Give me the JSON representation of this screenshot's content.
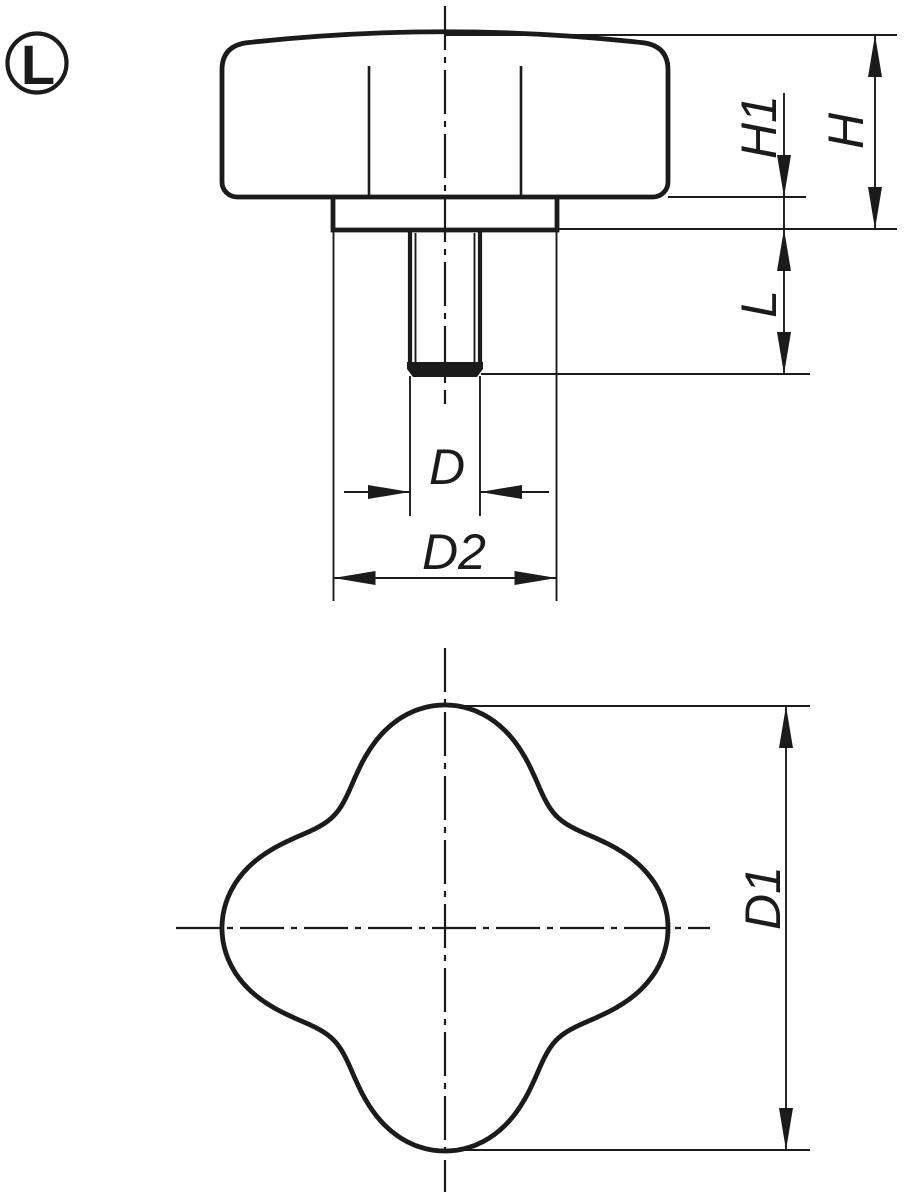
{
  "drawing": {
    "background_color": "#ffffff",
    "ink_color": "#1d1a1a",
    "variant_badge": {
      "label": "L"
    },
    "dimensions": {
      "h1": "H1",
      "h": "H",
      "l": "L",
      "d": "D",
      "d2": "D2",
      "d1": "D1"
    }
  }
}
